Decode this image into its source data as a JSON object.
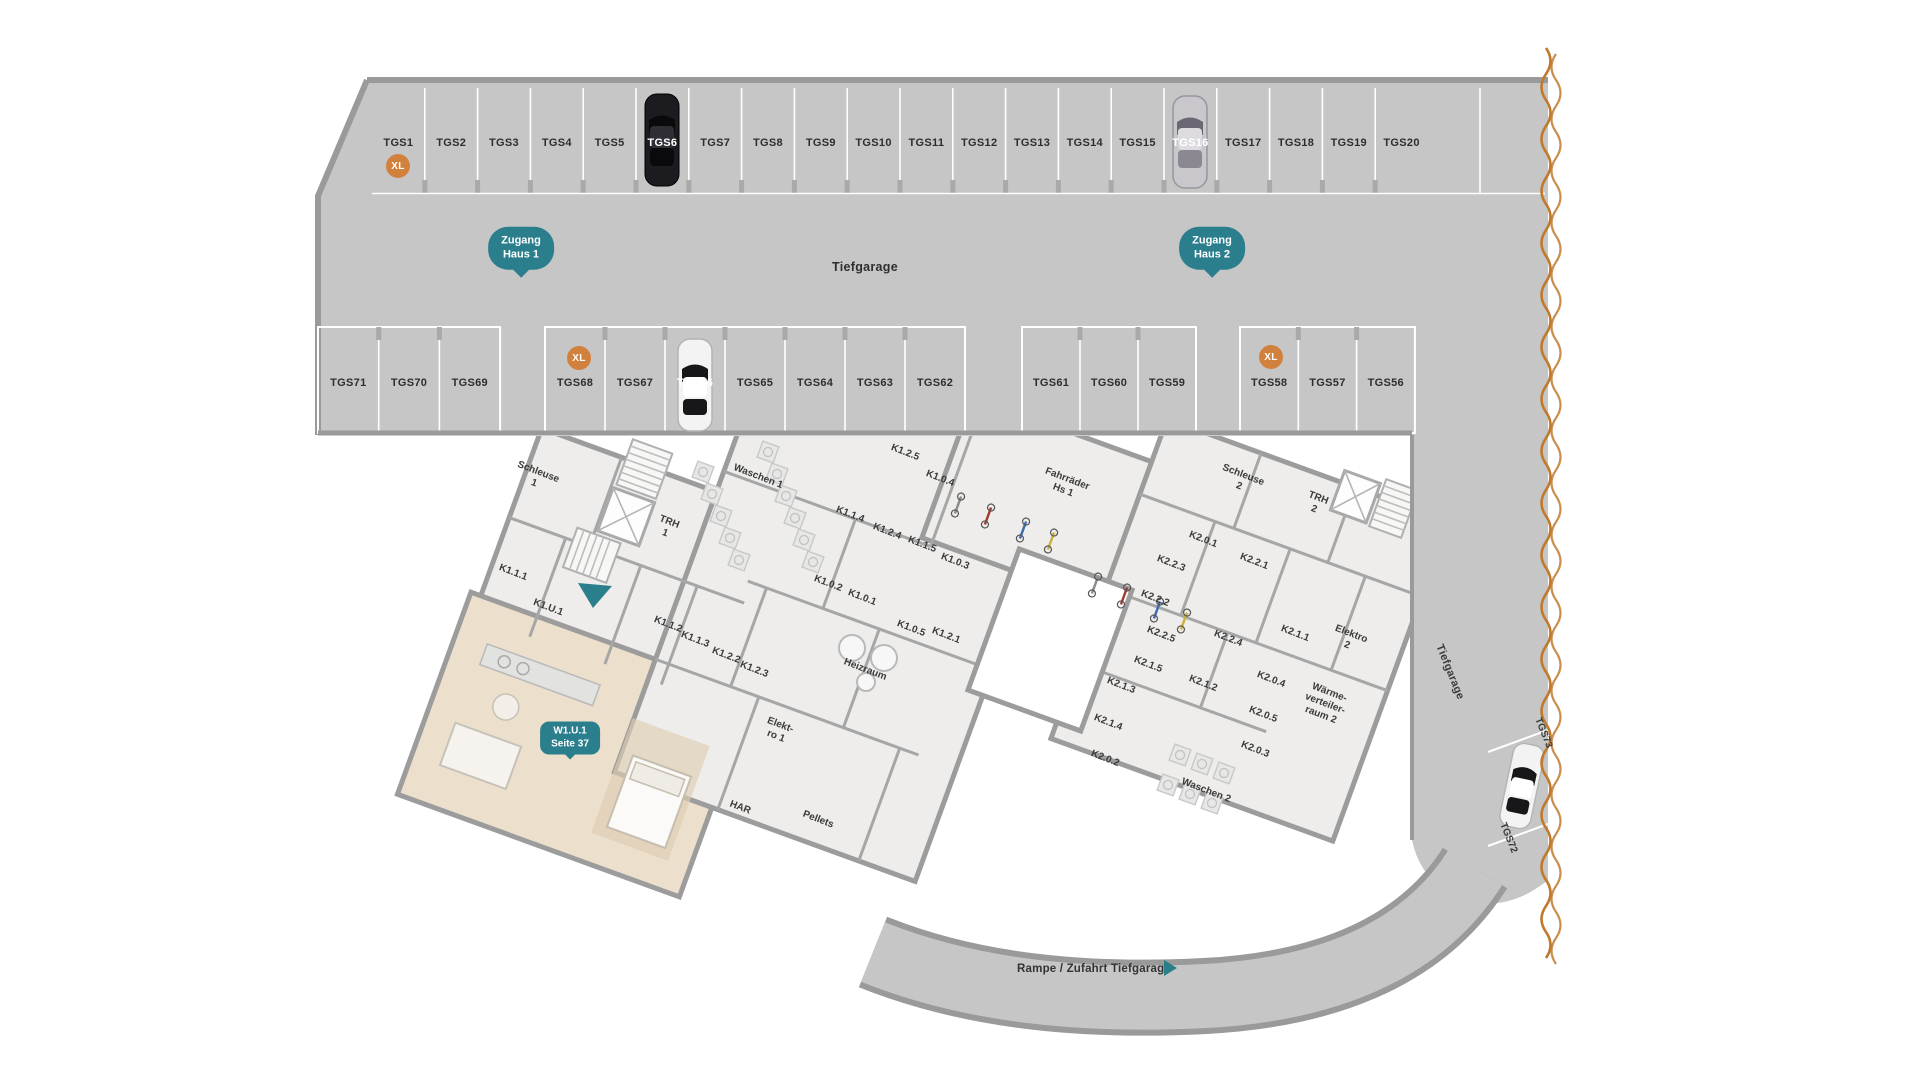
{
  "plan": {
    "garage_label": "Tiefgarage",
    "lane_label": "Tiefgarage",
    "ramp_label": "Rampe / Zufahrt Tiefgarage"
  },
  "badges": {
    "xl": "XL",
    "zugang_haus_1": [
      "Zugang",
      "Haus 1"
    ],
    "zugang_haus_2": [
      "Zugang",
      "Haus 2"
    ],
    "unit": [
      "W1.U.1",
      "Seite 37"
    ]
  },
  "parking": {
    "top_row": [
      "TGS1",
      "TGS2",
      "TGS3",
      "TGS4",
      "TGS5",
      "TGS6",
      "TGS7",
      "TGS8",
      "TGS9",
      "TGS10",
      "TGS11",
      "TGS12",
      "TGS13",
      "TGS14",
      "TGS15",
      "TGS16",
      "TGS17",
      "TGS18",
      "TGS19",
      "TGS20"
    ],
    "middle_groups": [
      [
        "TGS71",
        "TGS70",
        "TGS69"
      ],
      [
        "TGS68",
        "TGS67",
        "TGS66",
        "TGS65",
        "TGS64",
        "TGS63",
        "TGS62"
      ],
      [
        "TGS61",
        "TGS60",
        "TGS59"
      ],
      [
        "TGS58",
        "TGS57",
        "TGS56"
      ]
    ],
    "side_spots": [
      {
        "label": "TGS73",
        "x": 1543,
        "y": 733,
        "rot": 68
      },
      {
        "label": "TGS72",
        "x": 1508,
        "y": 838,
        "rot": 68
      }
    ],
    "car_spots": [
      "TGS6",
      "TGS16",
      "TGS66"
    ],
    "xl_badge_positions": [
      {
        "x": 398,
        "y": 166
      },
      {
        "x": 579,
        "y": 358
      },
      {
        "x": 1271,
        "y": 357
      }
    ]
  },
  "rooms": [
    {
      "lines": [
        "Schleuse",
        "1"
      ],
      "x": 536,
      "y": 478
    },
    {
      "lines": [
        "TRH",
        "1"
      ],
      "x": 667,
      "y": 528
    },
    {
      "lines": [
        "K1.1.1"
      ],
      "x": 513,
      "y": 573
    },
    {
      "lines": [
        "K1.U.1"
      ],
      "x": 548,
      "y": 608
    },
    {
      "lines": [
        "K1.1.2"
      ],
      "x": 668,
      "y": 625
    },
    {
      "lines": [
        "K1.1.3"
      ],
      "x": 695,
      "y": 640
    },
    {
      "lines": [
        "K1.2.2"
      ],
      "x": 726,
      "y": 656
    },
    {
      "lines": [
        "K1.2.3"
      ],
      "x": 754,
      "y": 670
    },
    {
      "lines": [
        "Waschen 1"
      ],
      "x": 758,
      "y": 477
    },
    {
      "lines": [
        "K1.2.5"
      ],
      "x": 905,
      "y": 453
    },
    {
      "lines": [
        "K1.0.4"
      ],
      "x": 940,
      "y": 479
    },
    {
      "lines": [
        "K1.1.4"
      ],
      "x": 850,
      "y": 515
    },
    {
      "lines": [
        "K1.2.4"
      ],
      "x": 887,
      "y": 532
    },
    {
      "lines": [
        "K1.1.5"
      ],
      "x": 922,
      "y": 545
    },
    {
      "lines": [
        "K1.0.3"
      ],
      "x": 955,
      "y": 562
    },
    {
      "lines": [
        "K1.0.2"
      ],
      "x": 828,
      "y": 584
    },
    {
      "lines": [
        "K1.0.1"
      ],
      "x": 862,
      "y": 598
    },
    {
      "lines": [
        "K1.0.5"
      ],
      "x": 911,
      "y": 629
    },
    {
      "lines": [
        "K1.2.1"
      ],
      "x": 946,
      "y": 636
    },
    {
      "lines": [
        "Heizraum"
      ],
      "x": 865,
      "y": 670
    },
    {
      "lines": [
        "Elekt-",
        "ro 1"
      ],
      "x": 778,
      "y": 731
    },
    {
      "lines": [
        "HAR"
      ],
      "x": 740,
      "y": 808
    },
    {
      "lines": [
        "Pellets"
      ],
      "x": 818,
      "y": 820
    },
    {
      "lines": [
        "Fahrräder",
        "Hs 1"
      ],
      "x": 1065,
      "y": 485
    },
    {
      "lines": [
        "Schleuse",
        "2"
      ],
      "x": 1241,
      "y": 481
    },
    {
      "lines": [
        "TRH",
        "2"
      ],
      "x": 1316,
      "y": 504
    },
    {
      "lines": [
        "K2.0.1"
      ],
      "x": 1203,
      "y": 540
    },
    {
      "lines": [
        "K2.2.3"
      ],
      "x": 1171,
      "y": 564
    },
    {
      "lines": [
        "K2.2.1"
      ],
      "x": 1254,
      "y": 562
    },
    {
      "lines": [
        "K2.2.2"
      ],
      "x": 1155,
      "y": 599
    },
    {
      "lines": [
        "K2.2.5"
      ],
      "x": 1161,
      "y": 635
    },
    {
      "lines": [
        "K2.2.4"
      ],
      "x": 1228,
      "y": 639
    },
    {
      "lines": [
        "K2.1.1"
      ],
      "x": 1295,
      "y": 634
    },
    {
      "lines": [
        "Elektro",
        "2"
      ],
      "x": 1349,
      "y": 640
    },
    {
      "lines": [
        "K2.1.5"
      ],
      "x": 1148,
      "y": 665
    },
    {
      "lines": [
        "K2.1.3"
      ],
      "x": 1121,
      "y": 686
    },
    {
      "lines": [
        "K2.1.2"
      ],
      "x": 1203,
      "y": 684
    },
    {
      "lines": [
        "K2.0.4"
      ],
      "x": 1271,
      "y": 680
    },
    {
      "lines": [
        "K2.0.5"
      ],
      "x": 1263,
      "y": 715
    },
    {
      "lines": [
        "Wärme-",
        "verteiler-",
        "raum 2"
      ],
      "x": 1325,
      "y": 704
    },
    {
      "lines": [
        "K2.1.4"
      ],
      "x": 1108,
      "y": 723
    },
    {
      "lines": [
        "K2.0.3"
      ],
      "x": 1255,
      "y": 750
    },
    {
      "lines": [
        "K2.0.2"
      ],
      "x": 1105,
      "y": 759
    },
    {
      "lines": [
        "Waschen 2"
      ],
      "x": 1206,
      "y": 791
    }
  ],
  "colors": {
    "teal": "#2b7e8c",
    "xl_orange": "#d2813d",
    "tear_orange": "#bf7a2e",
    "garage_gray": "#c6c6c6",
    "floor_gray": "#eeedeb",
    "wall_gray": "#9c9c9c",
    "apartment_beige": "#ece0cd"
  }
}
